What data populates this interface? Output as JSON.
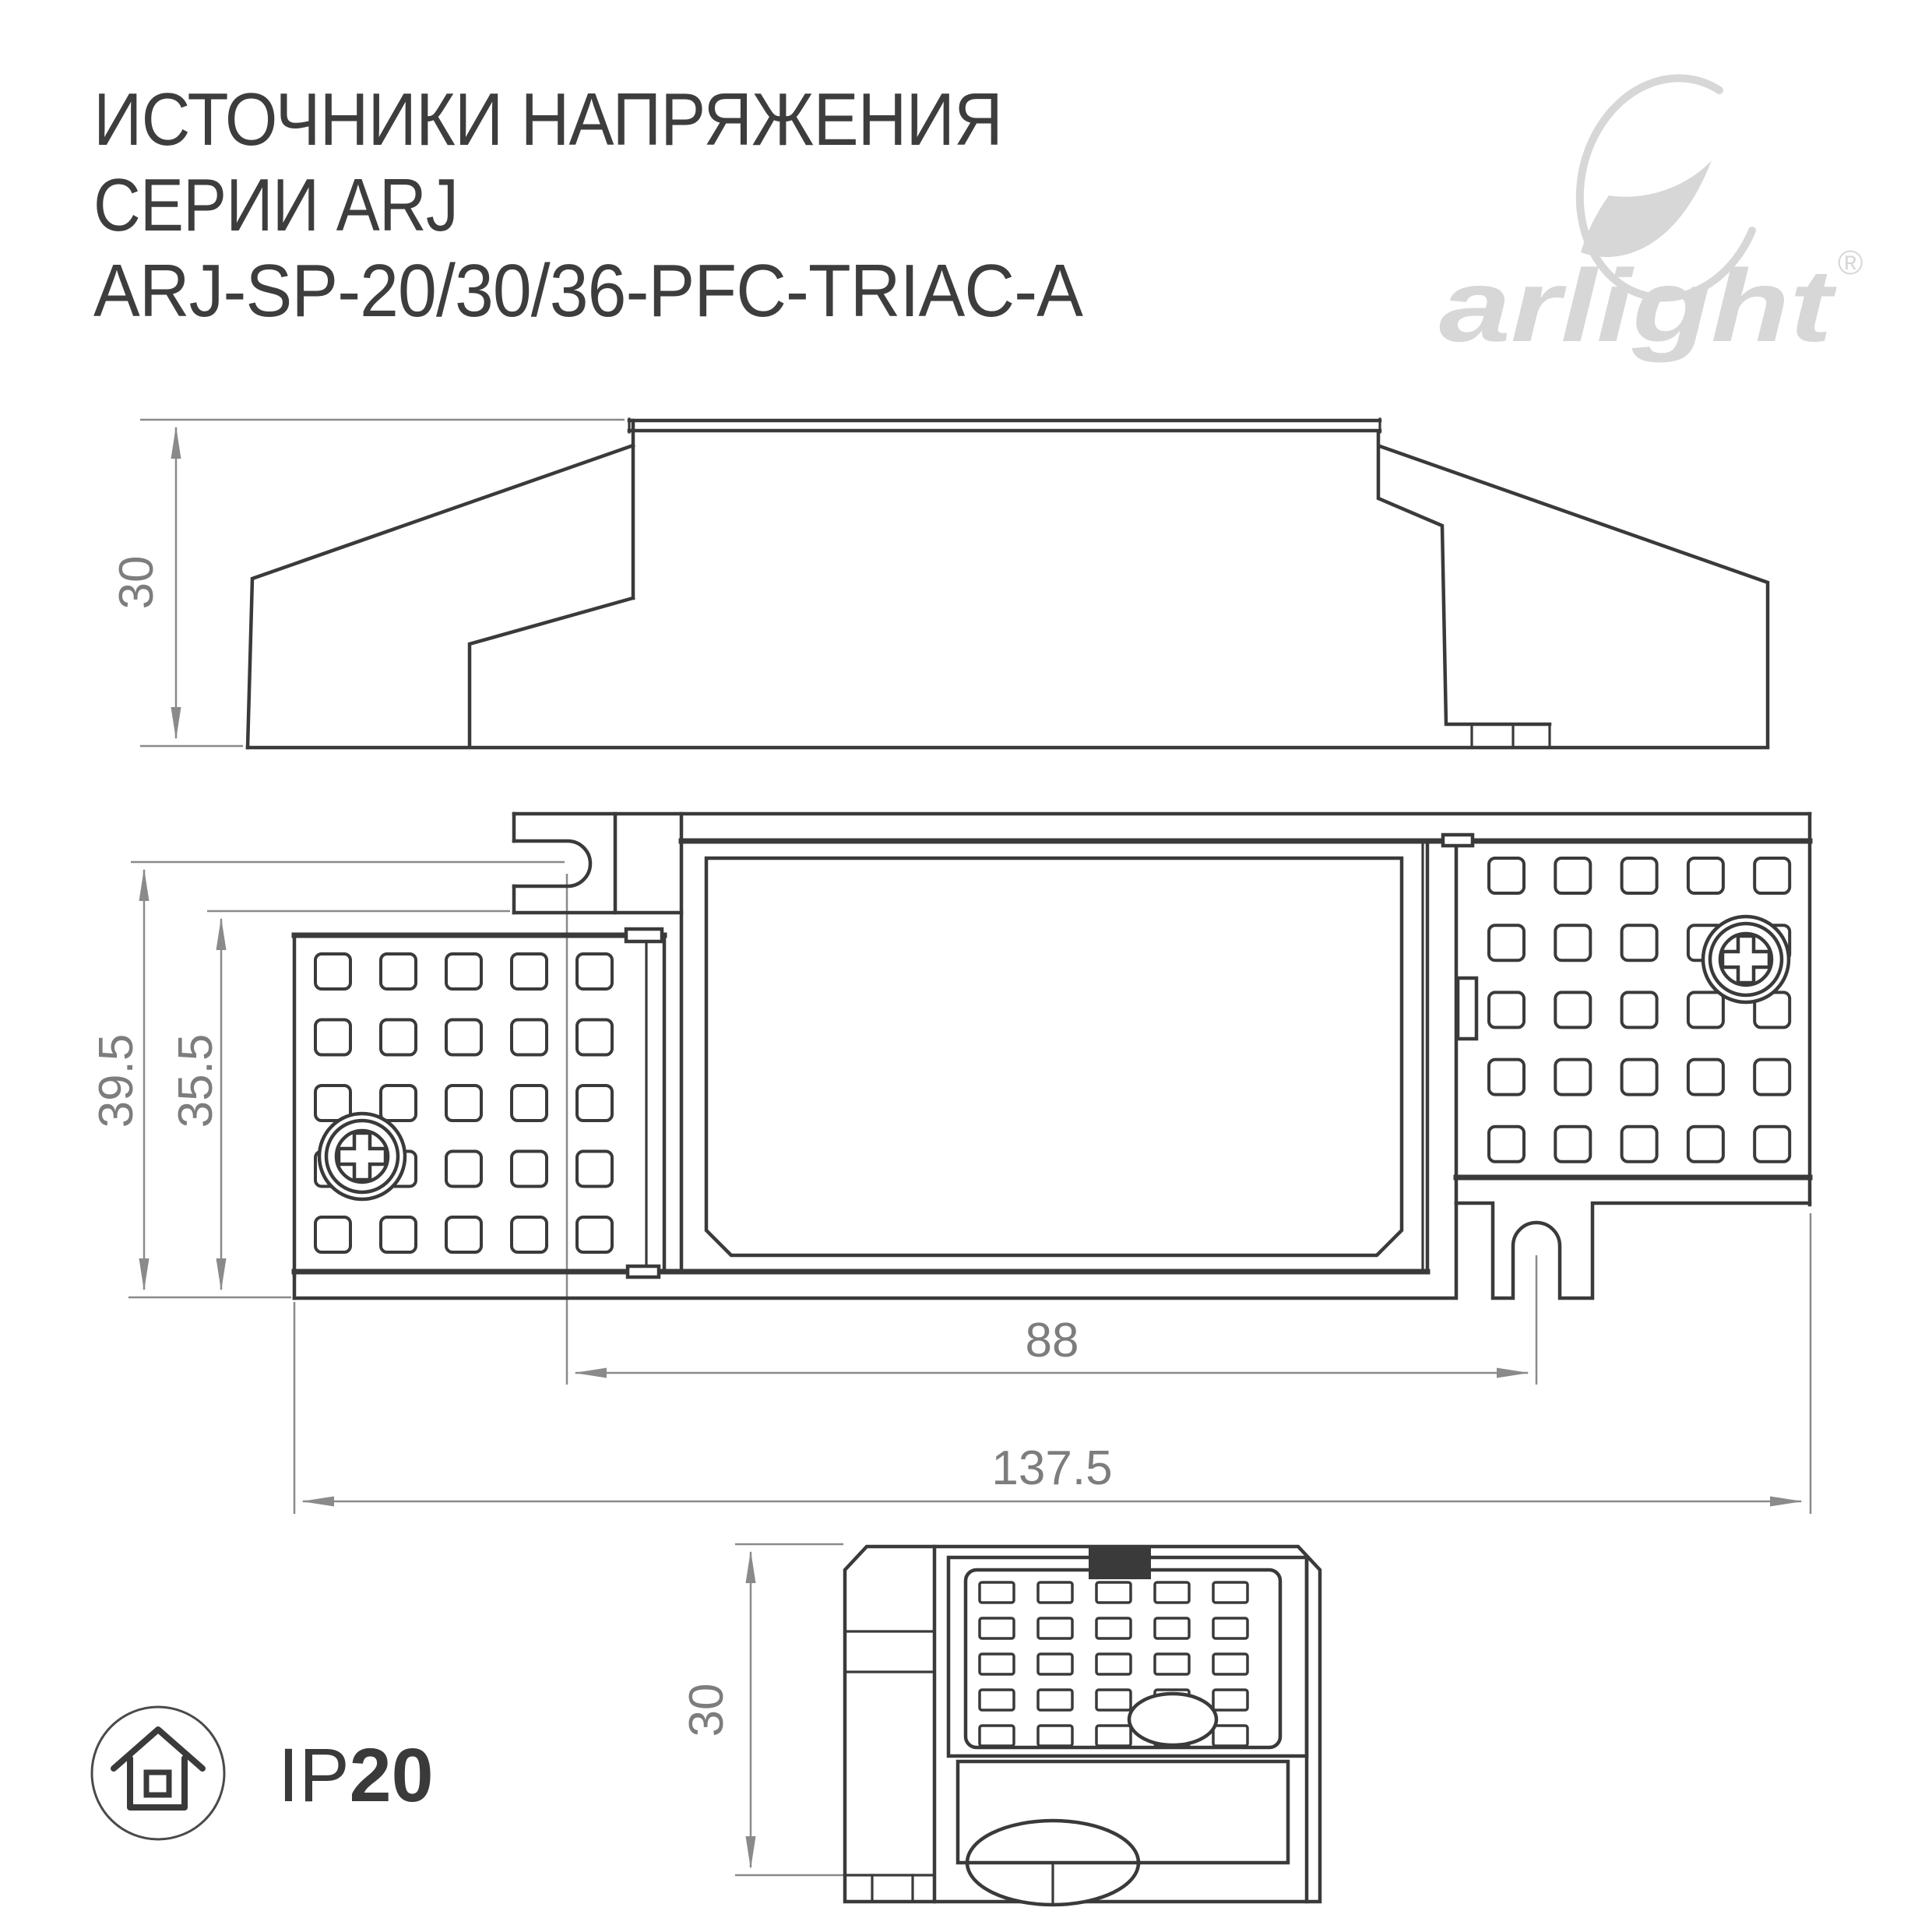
{
  "title": {
    "line1": "ИСТОЧНИКИ НАПРЯЖЕНИЯ",
    "line2": "СЕРИИ ARJ",
    "line3": "ARJ-SP-20/30/36-PFC-TRIAC-A"
  },
  "logo": {
    "brand": "arlight",
    "registered": "®",
    "icon": "arlight-swoosh-icon",
    "color": "#d7d7d7"
  },
  "drawing": {
    "line_color": "#3a3a3a",
    "dimension_color": "#8a8a8a",
    "dimension_text_color": "#7d7d7d",
    "views": {
      "side": {
        "height_dim": "30"
      },
      "top": {
        "height_dim": "39.5",
        "inner_height_dim": "35.5",
        "mount_hole_spacing_dim": "88",
        "length_dim": "137.5"
      },
      "front": {
        "height_dim": "30"
      }
    }
  },
  "badge": {
    "icon": "house-icon",
    "ip_prefix": "IP",
    "ip_value": "20"
  }
}
